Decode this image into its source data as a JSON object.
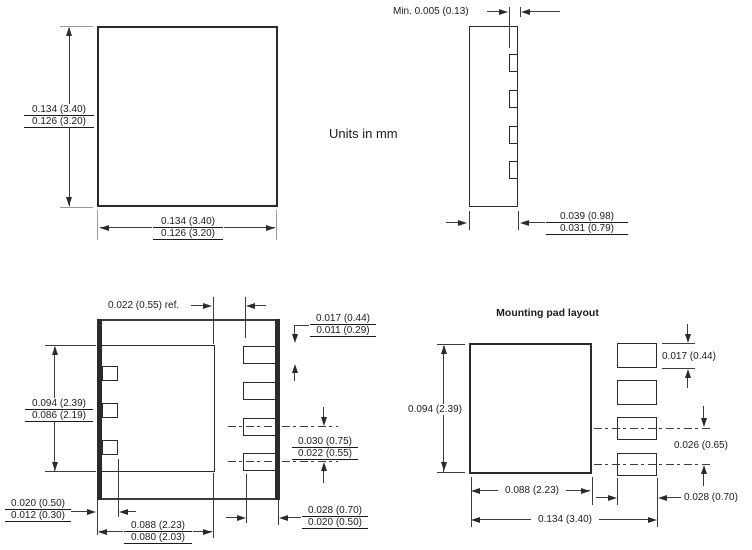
{
  "notes": {
    "units": "Units in mm"
  },
  "top_view": {
    "side_dim": {
      "max": "0.134 (3.40)",
      "min": "0.126 (3.20)"
    },
    "bottom_dim": {
      "max": "0.134 (3.40)",
      "min": "0.126 (3.20)"
    }
  },
  "side_view": {
    "standoff_dim": "Min. 0.005 (0.13)",
    "thickness_dim": {
      "max": "0.039 (0.98)",
      "min": "0.031 (0.79)"
    }
  },
  "bottom_view": {
    "pad_offset_ref_dim": "0.022 (0.55) ref.",
    "lead_width_dim": {
      "max": "0.017 (0.44)",
      "min": "0.011 (0.29)"
    },
    "epad_length_dim": {
      "max": "0.094 (2.39)",
      "min": "0.086 (2.19)"
    },
    "lead_pitch_dim": {
      "max": "0.030 (0.75)",
      "min": "0.022 (0.55)"
    },
    "lead_inset_dim": {
      "max": "0.020 (0.50)",
      "min": "0.012 (0.30)"
    },
    "epad_width_dim": {
      "max": "0.088 (2.23)",
      "min": "0.080 (2.03)"
    },
    "lead_length_dim": {
      "max": "0.028 (0.70)",
      "min": "0.020 (0.50)"
    }
  },
  "mounting_pad_layout": {
    "title": "Mounting pad layout",
    "pad_height_dim": "0.094 (2.39)",
    "pin_pad_width_dim": "0.017 (0.44)",
    "pin_pitch_dim": "0.026 (0.65)",
    "pin_pad_length_dim": "0.028 (0.70)",
    "center_pad_width_dim": "0.088 (2.23)",
    "overall_width_dim": "0.134 (3.40)"
  },
  "colors": {
    "line": "#2b2b2b",
    "text": "#1c1c1c",
    "background": "#ffffff"
  }
}
